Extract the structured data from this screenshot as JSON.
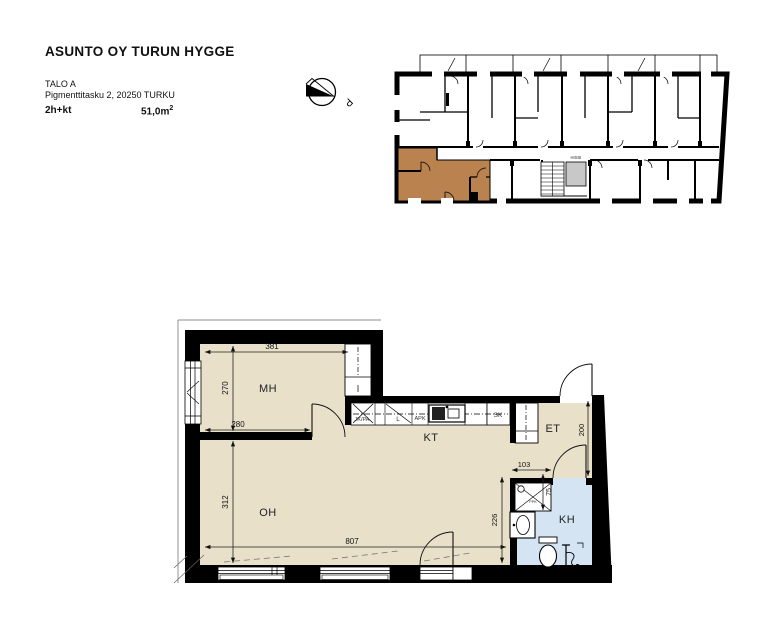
{
  "header": {
    "title": "ASUNTO OY TURUN HYGGE",
    "building": "TALO A",
    "address": "Pigmenttitasku 2, 20250 TURKU",
    "apartment_type": "2h+kt",
    "area_value": "51,0m",
    "area_sup": "2"
  },
  "north_label": "P",
  "overview": {
    "elevator_label": "HISSI"
  },
  "rooms": {
    "bedroom": "MH",
    "kitchen": "KT",
    "living": "OH",
    "hall": "ET",
    "bathroom": "KH"
  },
  "fixtures": {
    "fridge_freezer": "JK/PA",
    "stove": "L",
    "dishwasher": "APK",
    "cleaning_closet": "SK",
    "washer_reserve": "PPK"
  },
  "dims": {
    "d381": "381",
    "d270": "270",
    "d280": "280",
    "d312": "312",
    "d807": "807",
    "d226": "226",
    "d103": "103",
    "d200": "200",
    "d75": "75"
  },
  "colors": {
    "floor_beige": "#e9e0ca",
    "unit_highlight": "#b9824e",
    "bathroom_blue": "#d4e4f3",
    "wall_black": "#000000",
    "elevator_gray": "#c8c8c8"
  }
}
